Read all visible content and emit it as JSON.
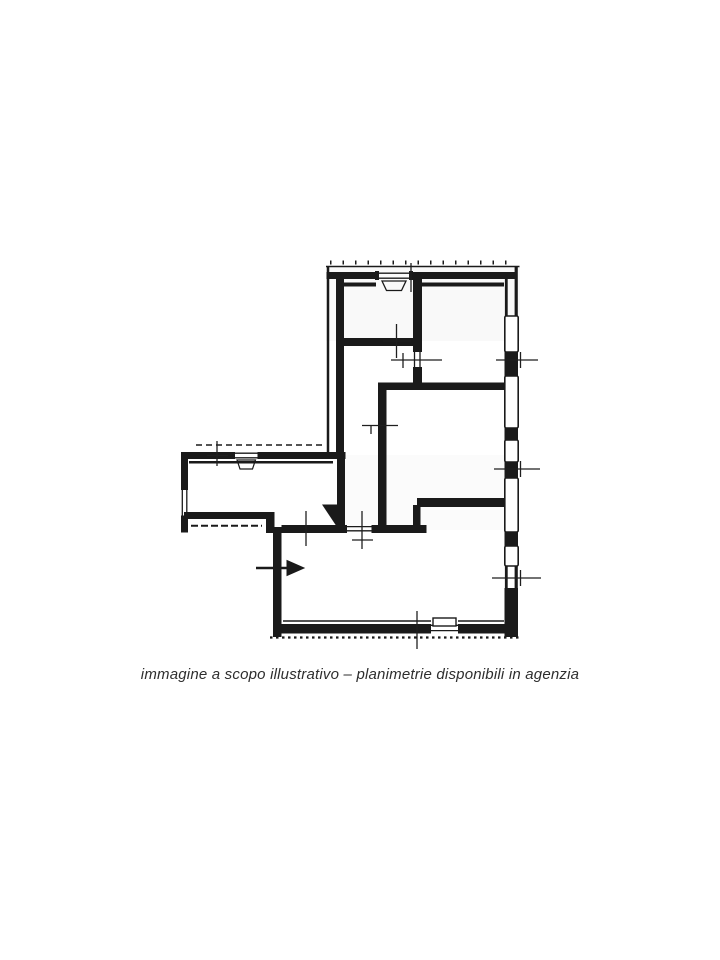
{
  "page": {
    "background_color": "#ffffff",
    "kind": "real-estate floor plan scan"
  },
  "floor_plan": {
    "ink_color": "#1a1a1a",
    "paper_color": "#ffffff",
    "marks": {
      "entrance_arrow": "arrow pointing right through the west wall of the lower room",
      "door_swing_triangle": "solid black triangle at inner corridor corner",
      "dimension_ticks": "thin cross tick marks on walls",
      "windows": "double-line window openings on exterior walls"
    }
  },
  "caption": {
    "text": "immagine a scopo illustrativo – planimetrie disponibili in agenzia",
    "color": "#2e2e2e"
  }
}
